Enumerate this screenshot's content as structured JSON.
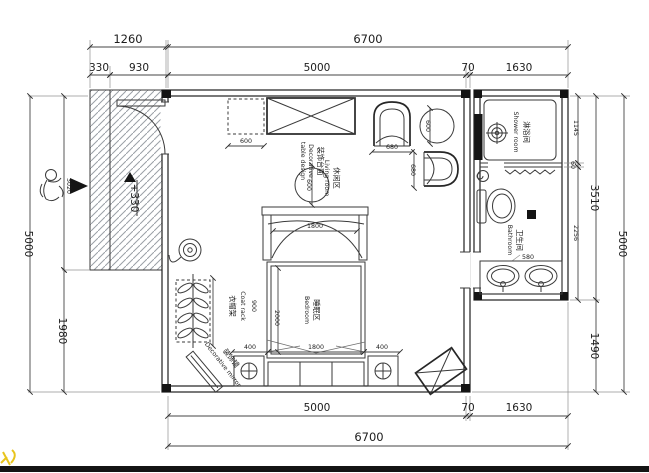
{
  "dims": {
    "t1260": "1260",
    "t6700": "6700",
    "t330": "330",
    "t930": "930",
    "t5000": "5000",
    "t70": "70",
    "t1630": "1630",
    "b5000": "5000",
    "b70": "70",
    "b1630": "1630",
    "b6700": "6700",
    "l5000": "5000",
    "l3020": "3020",
    "l1980": "1980",
    "r1145": "1145",
    "r60": "60",
    "r2256": "2256",
    "r3510": "3510",
    "r1490": "1490",
    "r5000": "5000"
  },
  "level": {
    "porch": "+330"
  },
  "rooms": {
    "living_zh": "休闲区",
    "living_en": "Living room",
    "bedroom_zh": "睡眠区",
    "bedroom_en": "Bedroom",
    "bathroom_zh": "卫生间",
    "bathroom_en": "Bathroom",
    "shower_zh": "淋浴间",
    "shower_en": "Shower room"
  },
  "annotations": {
    "decor_zh": "装饰台面",
    "decor_en1": "Decorative",
    "decor_en2": "table design",
    "coat_zh": "衣帽架",
    "coat_en": "Coat rack",
    "mirror_zh": "装饰镜",
    "mirror_en": "Decorative mirror"
  },
  "fdims": {
    "cab600": "600",
    "tbl600": "600",
    "side600": "600",
    "h680": "680",
    "v680": "680",
    "canopy1800": "1800",
    "bed2000": "2000",
    "bed400l": "400",
    "bed1800": "1800",
    "bed400r": "400",
    "rack900": "900",
    "vanity580": "580"
  },
  "colors": {
    "line": "#1f1f1f",
    "hatch": "#9aa0a6",
    "accent_bar": "#141414",
    "watermark": "#e8c41c"
  }
}
